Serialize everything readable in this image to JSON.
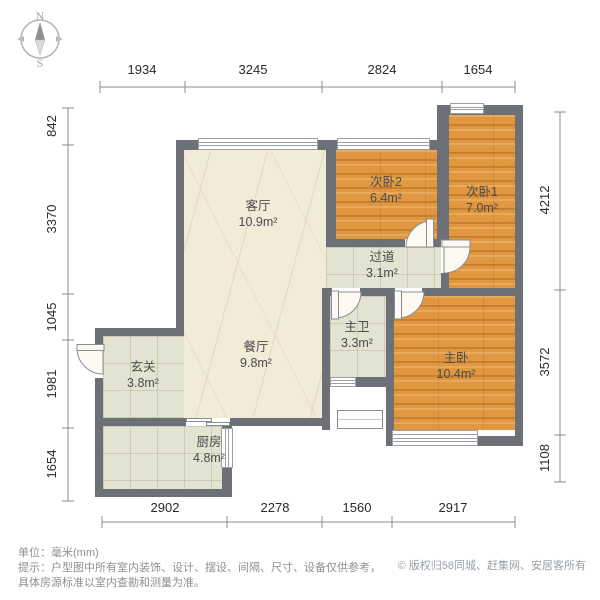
{
  "compass": {
    "north": "N",
    "south": "S"
  },
  "dimensions": {
    "top": [
      "1934",
      "3245",
      "2824",
      "1654"
    ],
    "left": [
      "842",
      "3370",
      "1045",
      "1981",
      "1654"
    ],
    "right": [
      "4212",
      "3572",
      "1108"
    ],
    "bottom": [
      "2902",
      "2278",
      "1560",
      "2917"
    ]
  },
  "rooms": {
    "living": {
      "name": "客厅",
      "area": "10.9m²"
    },
    "dining": {
      "name": "餐厅",
      "area": "9.8m²"
    },
    "bedroom2": {
      "name": "次卧2",
      "area": "6.4m²"
    },
    "bedroom1": {
      "name": "次卧1",
      "area": "7.0m²"
    },
    "hallway": {
      "name": "过道",
      "area": "3.1m²"
    },
    "master_bath": {
      "name": "主卫",
      "area": "3.3m²"
    },
    "master_bedroom": {
      "name": "主卧",
      "area": "10.4m²"
    },
    "entry": {
      "name": "玄关",
      "area": "3.8m²"
    },
    "kitchen": {
      "name": "厨房",
      "area": "4.8m²"
    }
  },
  "footer": {
    "unit": "单位：毫米(mm)",
    "tip_line1": "提示：户型图中所有室内装饰、设计、摆设、间隔、尺寸、设备仅供参考，",
    "tip_line2": "具体房源标准以室内查勘和测量为准。",
    "copyright": "© 版权归58同城、赶集网、安居客所有"
  },
  "colors": {
    "wall": "#6d7076",
    "wood_floor": "#e0973f",
    "marble_floor": "#f2ebd8",
    "tile_floor": "#e3e3d1",
    "dimension_text": "#2b2b2b",
    "footer_text": "#8f8f8f"
  }
}
